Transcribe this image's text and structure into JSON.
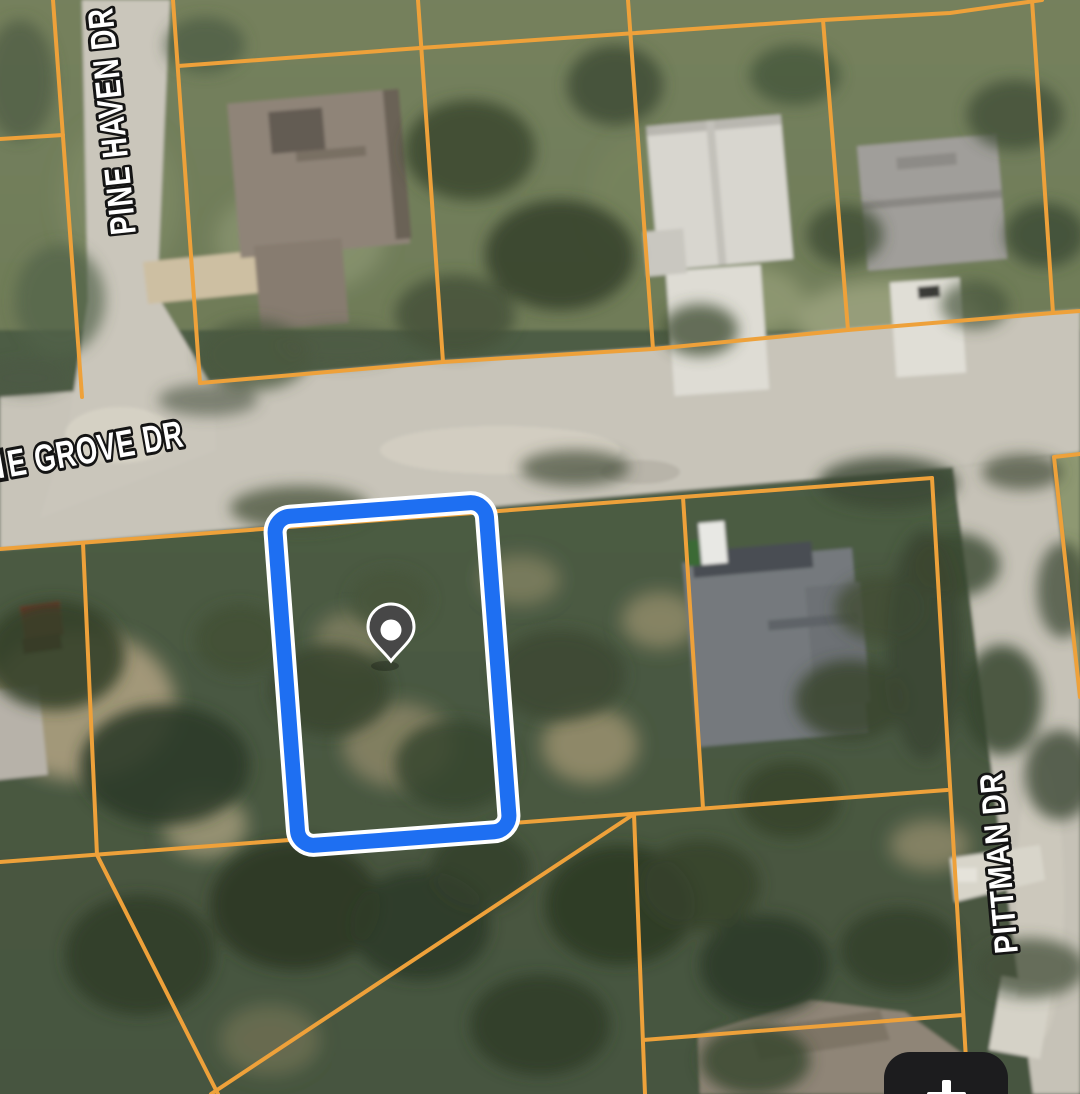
{
  "map": {
    "streets": [
      {
        "id": "pine-haven",
        "name": "PINE HAVEN DR"
      },
      {
        "id": "pine-grove",
        "name": "E GROVE DR"
      },
      {
        "id": "pittman",
        "name": "PITTMAN DR"
      }
    ],
    "colors": {
      "parcel_line": "#eea13a",
      "highlight_blue": "#1e6ff2",
      "highlight_outline": "#ffffff",
      "pin_body": "#474747",
      "pin_dot": "#ffffff"
    },
    "selected_parcel": {
      "marker": "location-pin"
    }
  },
  "controls": {
    "zoom_in_icon": "plus",
    "button_bg": "#1c1c1e"
  }
}
